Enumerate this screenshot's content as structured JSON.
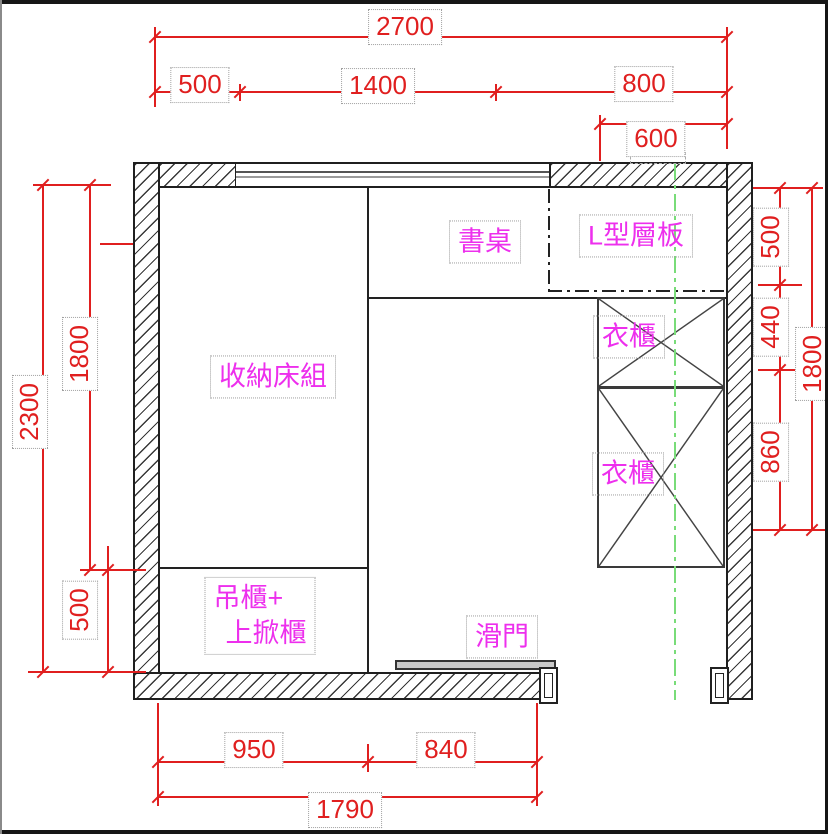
{
  "drawing": {
    "title": "room-furniture-plan",
    "dims": {
      "top_overall": "2700",
      "top_seg1": "500",
      "top_seg2": "1400",
      "top_seg3": "800",
      "top_sub": "600",
      "left_overall": "2300",
      "left_upper": "1800",
      "left_lower": "500",
      "right_seg1": "500",
      "right_seg2": "440",
      "right_seg3": "860",
      "right_overall": "1800",
      "bottom_seg1": "950",
      "bottom_seg2": "840",
      "bottom_overall": "1790"
    },
    "labels": {
      "desk": "書桌",
      "l_shelf": "L型層板",
      "wardrobe_top": "衣櫃",
      "wardrobe_bottom": "衣櫃",
      "storage_bed": "收納床組",
      "cabinet_line1": "吊櫃+",
      "cabinet_line2": "上掀櫃",
      "sliding_door": "滑門"
    },
    "colors": {
      "dimension": "#e01f1f",
      "label": "#ed2fed",
      "wall_line": "#1f1f1f",
      "centerline": "#79dc79"
    }
  }
}
